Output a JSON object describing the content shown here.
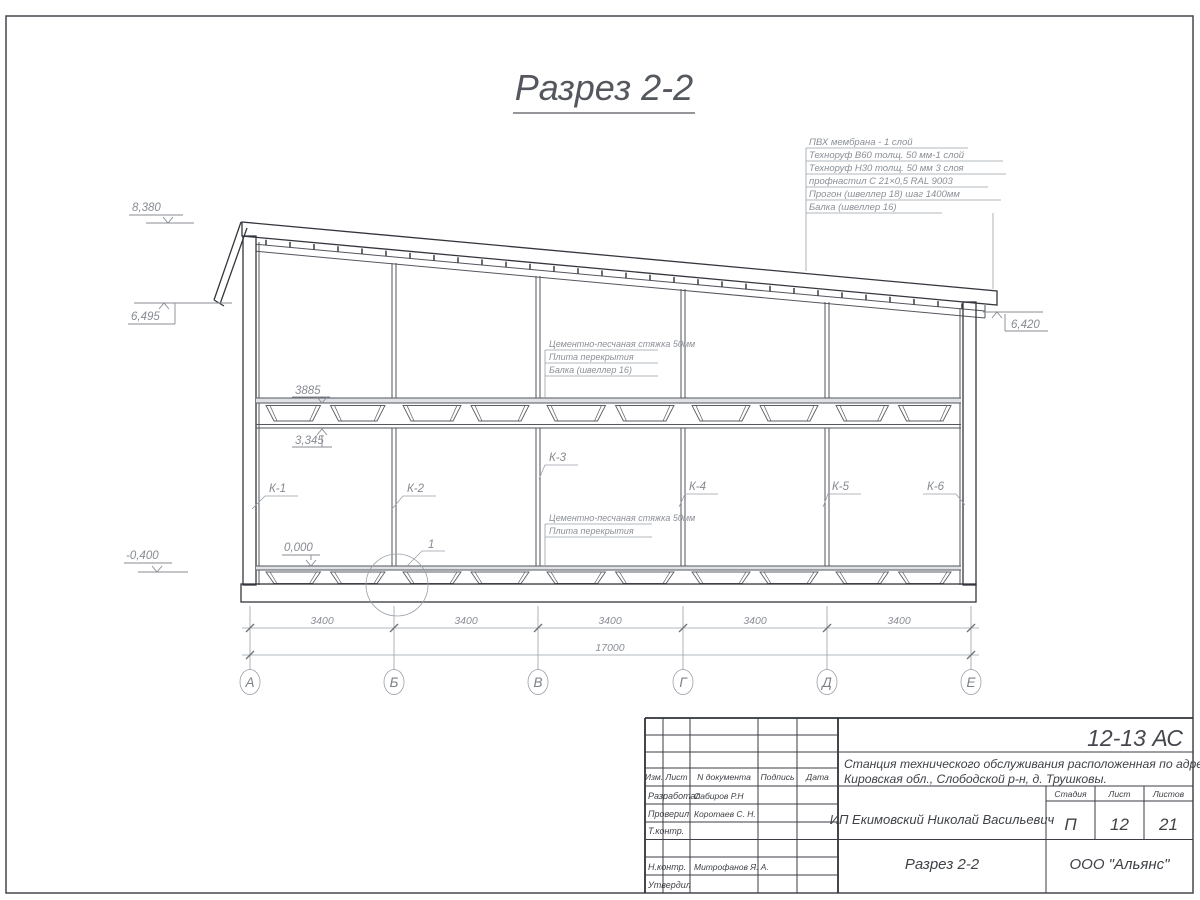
{
  "drawing_title": "Разрез 2-2",
  "roof_callout": [
    "ПВХ мембрана - 1 слой",
    "Техноруф В60 толщ. 50 мм-1 слой",
    "Техноруф Н30 толщ. 50 мм 3 слоя",
    "профнастил С 21×0,5 RAL 9003",
    "Прогон (швеллер 18) шаг 1400мм",
    "Балка (швеллер 16)"
  ],
  "floor_callout_upper": [
    "Цементно-песчаная стяжка 50мм",
    "Плита перекрытия",
    "Балка (швеллер 16)"
  ],
  "floor_callout_lower": [
    "Цементно-песчаная стяжка 50мм",
    "Плита перекрытия"
  ],
  "elevations": {
    "ridge": "8,380",
    "left_eave": "6,495",
    "right_eave": "6,420",
    "deck_top": "3885",
    "beam_bottom": "3,345",
    "floor_zero": "0,000",
    "ground": "-0,400"
  },
  "column_labels": [
    "К-1",
    "К-2",
    "К-3",
    "К-4",
    "К-5",
    "К-6"
  ],
  "detail_label": "1",
  "dims": {
    "bays": [
      "3400",
      "3400",
      "3400",
      "3400",
      "3400"
    ],
    "total": "17000"
  },
  "axes": [
    "А",
    "Б",
    "В",
    "Г",
    "Д",
    "Е"
  ],
  "title_block": {
    "doc_code": "12-13 АС",
    "project_line1": "Станция технического обслуживания расположенная по адресу",
    "project_line2": "Кировская обл., Слободской р-н, д. Трушковы.",
    "client": "ИП Екимовский Николай Васильевич",
    "sheet_title": "Разрез 2-2",
    "organization": "ООО \"Альянс\"",
    "header": [
      "Изм.",
      "Лист",
      "N документа",
      "Подпись",
      "Дата"
    ],
    "stage_label": "Стадия",
    "sheet_label": "Лист",
    "sheets_label": "Листов",
    "stage": "П",
    "sheet": "12",
    "sheets": "21",
    "rows": [
      {
        "role": "Разработал",
        "name": "Сабиров Р.Н"
      },
      {
        "role": "Проверил",
        "name": "Коротаев С. Н."
      },
      {
        "role": "Т.контр.",
        "name": ""
      },
      {
        "role": "",
        "name": ""
      },
      {
        "role": "Н.контр.",
        "name": "Митрофанов Я. А."
      },
      {
        "role": "Утвердил",
        "name": ""
      }
    ]
  }
}
